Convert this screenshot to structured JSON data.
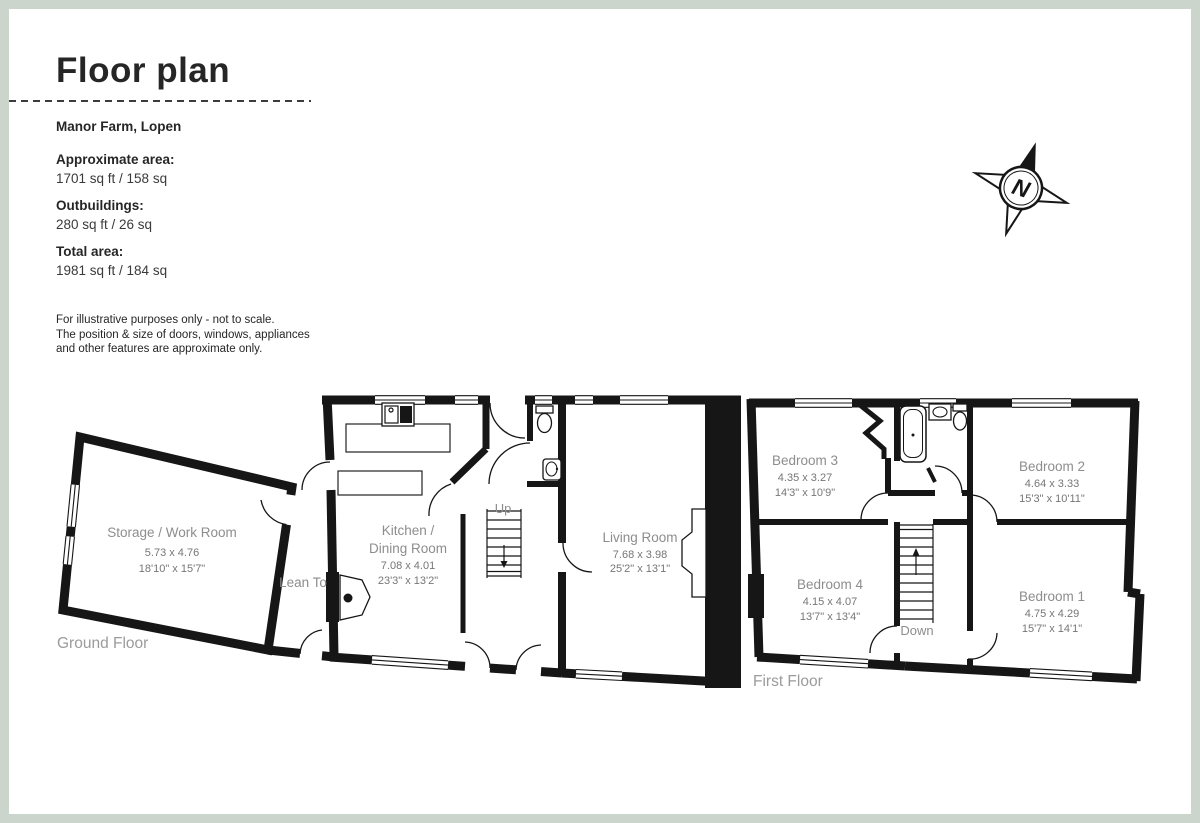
{
  "header": {
    "title": "Floor plan",
    "property": "Manor Farm, Lopen"
  },
  "areas": {
    "approximate_label": "Approximate area:",
    "approximate_value": "1701 sq ft / 158 sq",
    "outbuildings_label": "Outbuildings:",
    "outbuildings_value": "280 sq ft / 26 sq",
    "total_label": "Total area:",
    "total_value": "1981 sq ft / 184 sq"
  },
  "disclaimer": {
    "line1": "For illustrative purposes only - not to scale.",
    "line2": "The position & size of doors, windows, appliances",
    "line3": "and other features are approximate only."
  },
  "compass": {
    "north_label": "N"
  },
  "ground_floor": {
    "label": "Ground Floor",
    "stairs": "Up",
    "storage": {
      "name": "Storage / Work Room",
      "metric": "5.73 x 4.76",
      "imperial": "18'10\" x 15'7\""
    },
    "lean_to": {
      "name": "Lean To"
    },
    "kitchen": {
      "name_line1": "Kitchen /",
      "name_line2": "Dining Room",
      "metric": "7.08 x 4.01",
      "imperial": "23'3\" x 13'2\""
    },
    "living": {
      "name": "Living Room",
      "metric": "7.68 x 3.98",
      "imperial": "25'2\" x 13'1\""
    }
  },
  "first_floor": {
    "label": "First Floor",
    "stairs": "Down",
    "bedroom3": {
      "name": "Bedroom 3",
      "metric": "4.35 x 3.27",
      "imperial": "14'3\" x 10'9\""
    },
    "bedroom2": {
      "name": "Bedroom 2",
      "metric": "4.64 x 3.33",
      "imperial": "15'3\" x 10'11\""
    },
    "bedroom4": {
      "name": "Bedroom 4",
      "metric": "4.15 x 4.07",
      "imperial": "13'7\" x 13'4\""
    },
    "bedroom1": {
      "name": "Bedroom 1",
      "metric": "4.75 x 4.29",
      "imperial": "15'7\" x 14'1\""
    }
  },
  "colors": {
    "border": "#ccd5cc",
    "wall": "#161616"
  }
}
